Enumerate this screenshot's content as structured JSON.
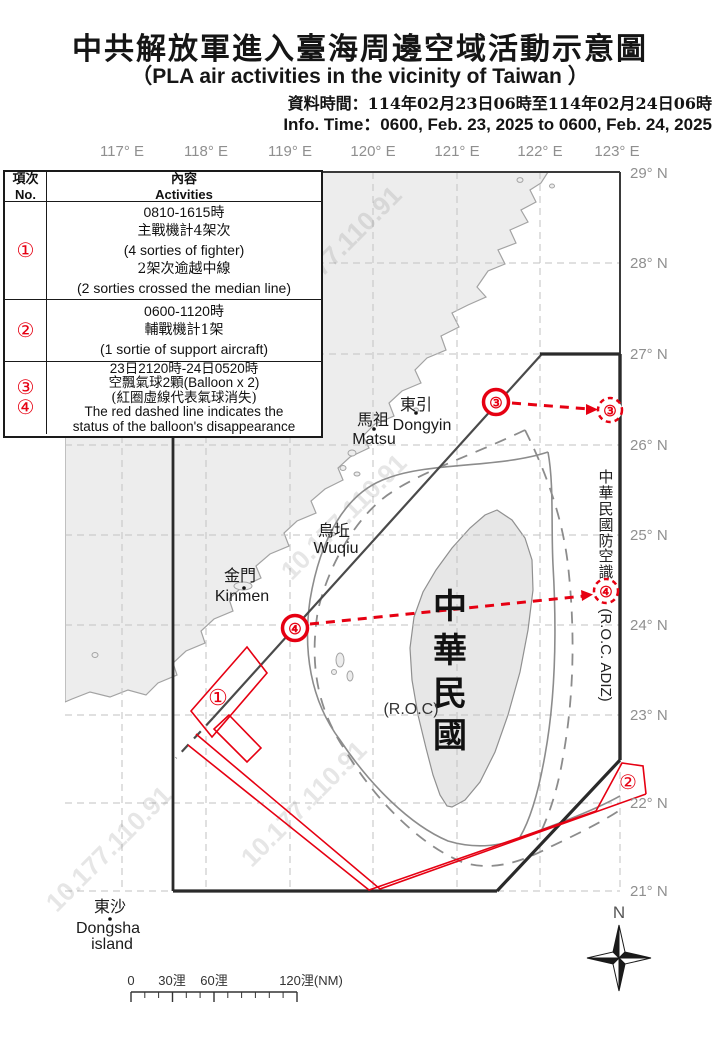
{
  "header": {
    "title_zh": "中共解放軍進入臺海周邊空域活動示意圖",
    "title_en": "（PLA air activities in the vicinity of Taiwan ）",
    "info_time_zh": "資料時間：114年02月23日06時至114年02月24日06時",
    "info_time_en": "Info. Time：0600, Feb. 23, 2025 to 0600, Feb. 24, 2025"
  },
  "table": {
    "no_header_zh": "項次",
    "no_header_en": "No.",
    "content_header_zh": "內容",
    "content_header_en": "Activities",
    "rows": [
      {
        "no": [
          "①"
        ],
        "lines": [
          "0810-1615時",
          "主戰機計4架次",
          "(4 sorties of fighter)",
          "2架次逾越中線",
          "(2 sorties crossed the median line)"
        ]
      },
      {
        "no": [
          "②"
        ],
        "lines": [
          "0600-1120時",
          "輔戰機計1架",
          "(1 sortie of support aircraft)"
        ]
      },
      {
        "no": [
          "③",
          "④"
        ],
        "lines": [
          "23日2120時-24日0520時",
          "空飄氣球2顆(Balloon x 2)",
          "(紅圈虛線代表氣球消失)",
          "The red dashed line indicates the",
          "status of the balloon's disappearance"
        ]
      }
    ]
  },
  "map": {
    "lon_labels": [
      "117° E",
      "118° E",
      "119° E",
      "120° E",
      "121° E",
      "122° E",
      "123° E"
    ],
    "lat_labels": [
      "29° N",
      "28° N",
      "27° N",
      "26° N",
      "25° N",
      "24° N",
      "23° N",
      "22° N",
      "21° N"
    ],
    "places": {
      "dongyin_zh": "東引",
      "dongyin_en": "Dongyin",
      "matsu_zh": "馬祖",
      "matsu_en": "Matsu",
      "wuqiu_zh": "烏坵",
      "wuqiu_en": "Wuqiu",
      "kinmen_zh": "金門",
      "kinmen_en": "Kinmen",
      "dongsha_zh": "東沙",
      "dongsha_en1": "Dongsha",
      "dongsha_en2": "island"
    },
    "roc_zh": [
      "中",
      "華",
      "民",
      "國"
    ],
    "roc_en": "(R.O.C)",
    "adiz_chars": [
      "中",
      "華",
      "民",
      "國",
      "防",
      "空",
      "識",
      "別"
    ],
    "adiz_en": "(R.O.C. ADIZ)",
    "markers": {
      "n1": "①",
      "n2": "②",
      "n3": "③",
      "n4": "④"
    },
    "watermark": "10.177.110.91",
    "compass": "N"
  },
  "scalebar": {
    "l0": "0",
    "l30": "30浬",
    "l60": "60浬",
    "l120": "120浬(NM)"
  },
  "colors": {
    "red": "#e60012",
    "dark_line": "#2a2a2a",
    "median_line": "#4a4a4a",
    "contour_gray": "#8c8c8c",
    "grid_gray": "#c2c2c2",
    "land_fill": "#ededed",
    "coast_stroke": "#a3a3a3",
    "label_gray": "#8f8f8f"
  }
}
